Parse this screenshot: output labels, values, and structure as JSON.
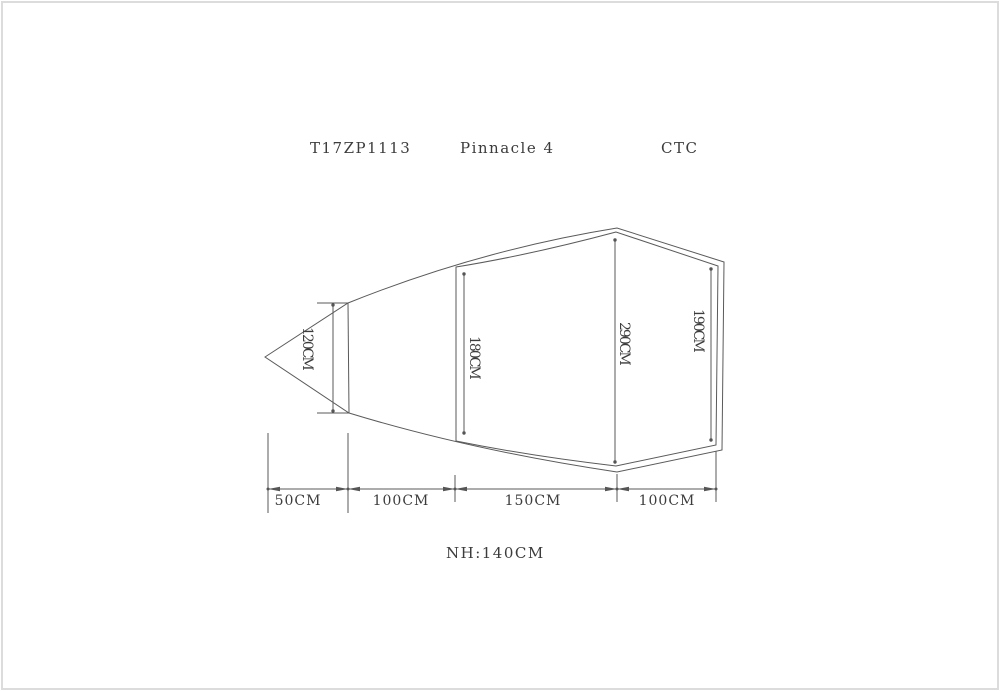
{
  "header": {
    "code": "T17ZP1113",
    "name": "Pinnacle 4",
    "suffix": "CTC"
  },
  "dims": {
    "vertical_labels": [
      "120CM",
      "180CM",
      "290CM",
      "190CM"
    ],
    "horizontal_labels": [
      "50CM",
      "100CM",
      "150CM",
      "100CM"
    ],
    "height_note": "NH:140CM"
  },
  "colors": {
    "line": "#5a5a5a",
    "text": "#3c3c3c",
    "border": "#dcdcdc",
    "background": "#ffffff"
  }
}
